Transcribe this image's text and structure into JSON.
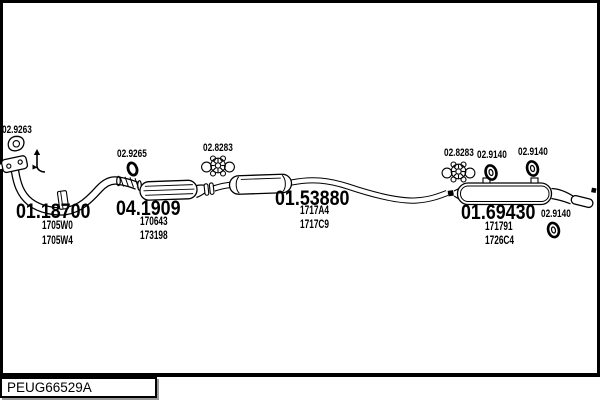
{
  "frame": {
    "background": "#ffffff",
    "line_color": "#000000"
  },
  "footer": {
    "catalog_code": "PEUG66529A"
  },
  "sections": [
    {
      "component": "front-pipe",
      "code": "01.18700",
      "part_refs": [
        "1705W0",
        "1705W4"
      ]
    },
    {
      "component": "catalytic-converter",
      "code": "04.1909",
      "part_refs": [
        "170643",
        "173198"
      ]
    },
    {
      "component": "centre-silencer",
      "code": "01.53880",
      "part_refs": [
        "1717A4",
        "1717C9"
      ]
    },
    {
      "component": "rear-silencer",
      "code": "01.69430",
      "part_refs": [
        "171791",
        "1726C4"
      ]
    }
  ],
  "fittings": [
    {
      "code": "02.9263",
      "icon": "gasket-icon"
    },
    {
      "code": "02.9265",
      "icon": "clamp-icon"
    },
    {
      "code": "02.8283",
      "icon": "rubber-mount-icon"
    },
    {
      "code": "02.8283",
      "icon": "rubber-mount-icon"
    },
    {
      "code": "02.9140",
      "icon": "rubber-ring-icon"
    },
    {
      "code": "02.9140",
      "icon": "rubber-ring-icon"
    },
    {
      "code": "02.9140",
      "icon": "rubber-ring-icon"
    }
  ]
}
